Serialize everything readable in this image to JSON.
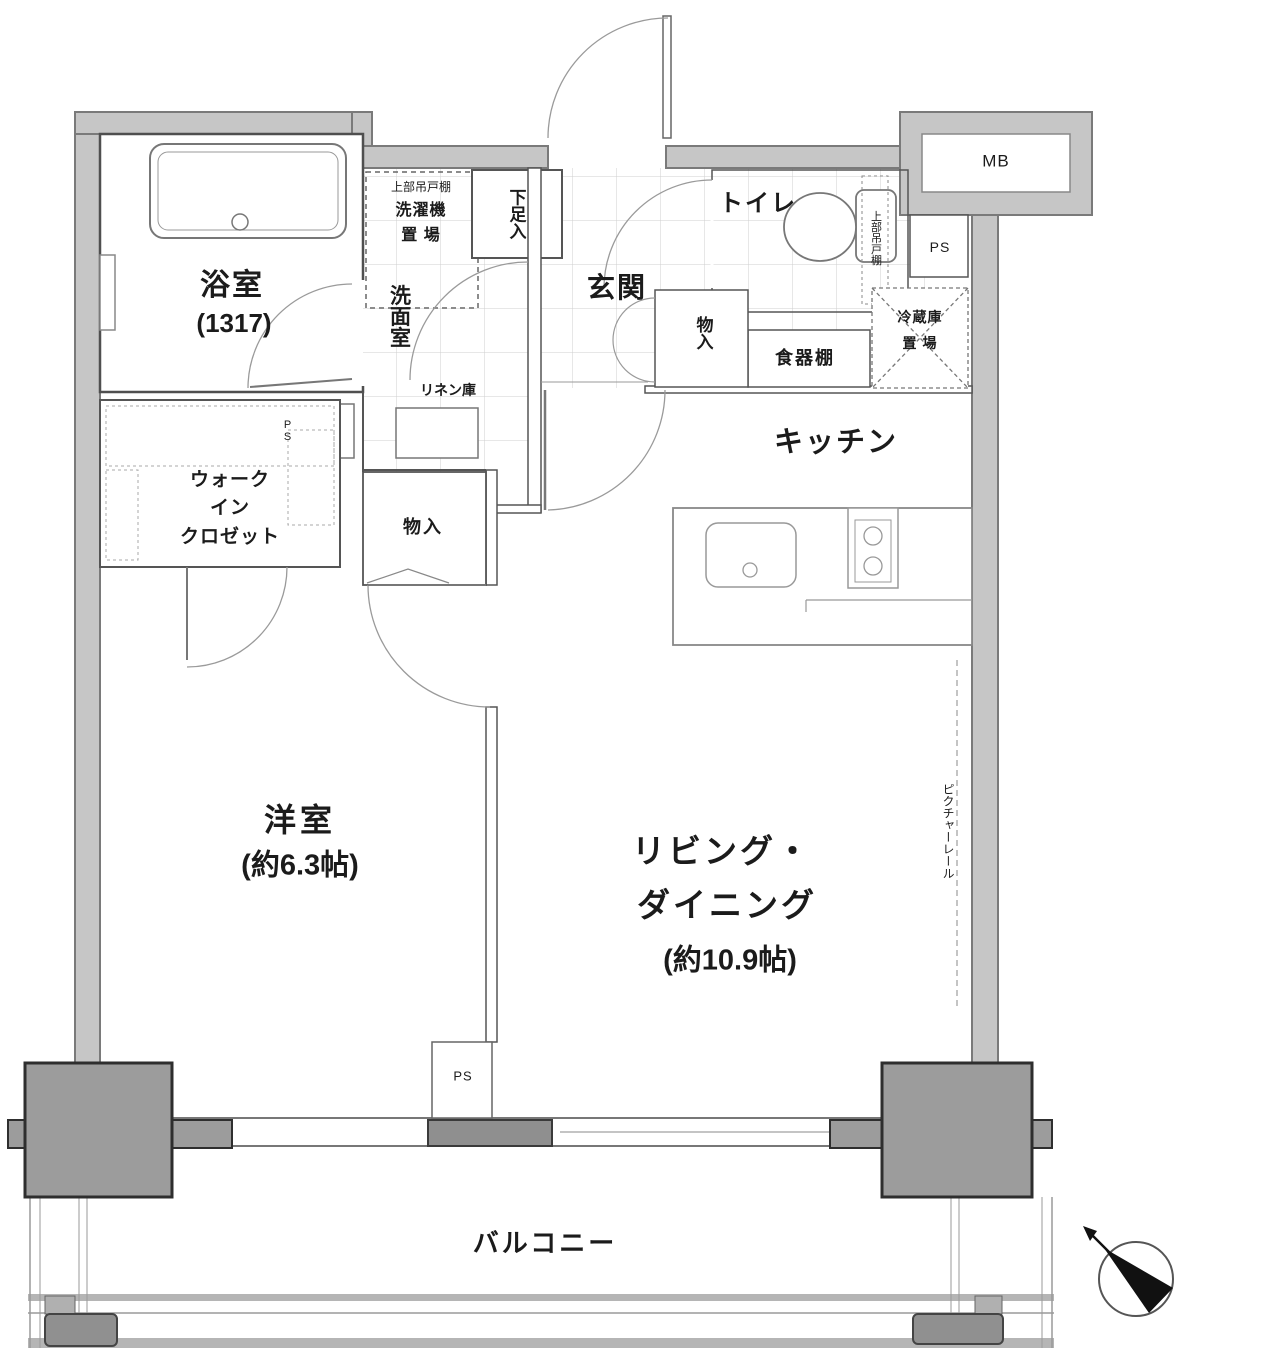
{
  "colors": {
    "wall_fill": "#c6c6c6",
    "wall_edge": "#7a7a7a",
    "pillar_fill": "#9c9c9c",
    "interior_line": "#555555",
    "door_arc": "#9a9a9a",
    "dark_fixture": "#8f8f8f",
    "tile_line": "#cfcfcf"
  },
  "rooms": {
    "bath": {
      "label": "浴室",
      "size": "(1317)"
    },
    "washer_area": {
      "shelf": "上部吊戸棚",
      "line1": "洗濯機",
      "line2": "置 場"
    },
    "shoe_cabinet": {
      "label": "下足入"
    },
    "entrance": {
      "label": "玄関"
    },
    "toilet": {
      "label": "トイレ",
      "shelf": "上部吊戸棚"
    },
    "meter_box": {
      "label": "MB"
    },
    "pipe_space_top": {
      "label": "PS"
    },
    "pipe_space_mid": {
      "label": "PS"
    },
    "pipe_space_bottom": {
      "label": "PS"
    },
    "refrigerator": {
      "line1": "冷蔵庫",
      "line2": "置 場"
    },
    "cupboard": {
      "label": "食器棚"
    },
    "hall_storage": {
      "label": "物入"
    },
    "center_storage": {
      "label": "物入"
    },
    "kitchen": {
      "label": "キッチン"
    },
    "washroom": {
      "label": "洗面室"
    },
    "linen": {
      "label": "リネン庫"
    },
    "walk_in_closet": {
      "line1": "ウォーク",
      "line2": "イン",
      "line3": "クロゼット"
    },
    "western_room": {
      "label": "洋室",
      "size": "(約6.3帖)"
    },
    "living_dining": {
      "line1": "リビング・",
      "line2": "ダイニング",
      "size": "(約10.9帖)"
    },
    "picture_rail": {
      "label": "ピクチャーレール"
    },
    "balcony": {
      "label": "バルコニー"
    }
  }
}
